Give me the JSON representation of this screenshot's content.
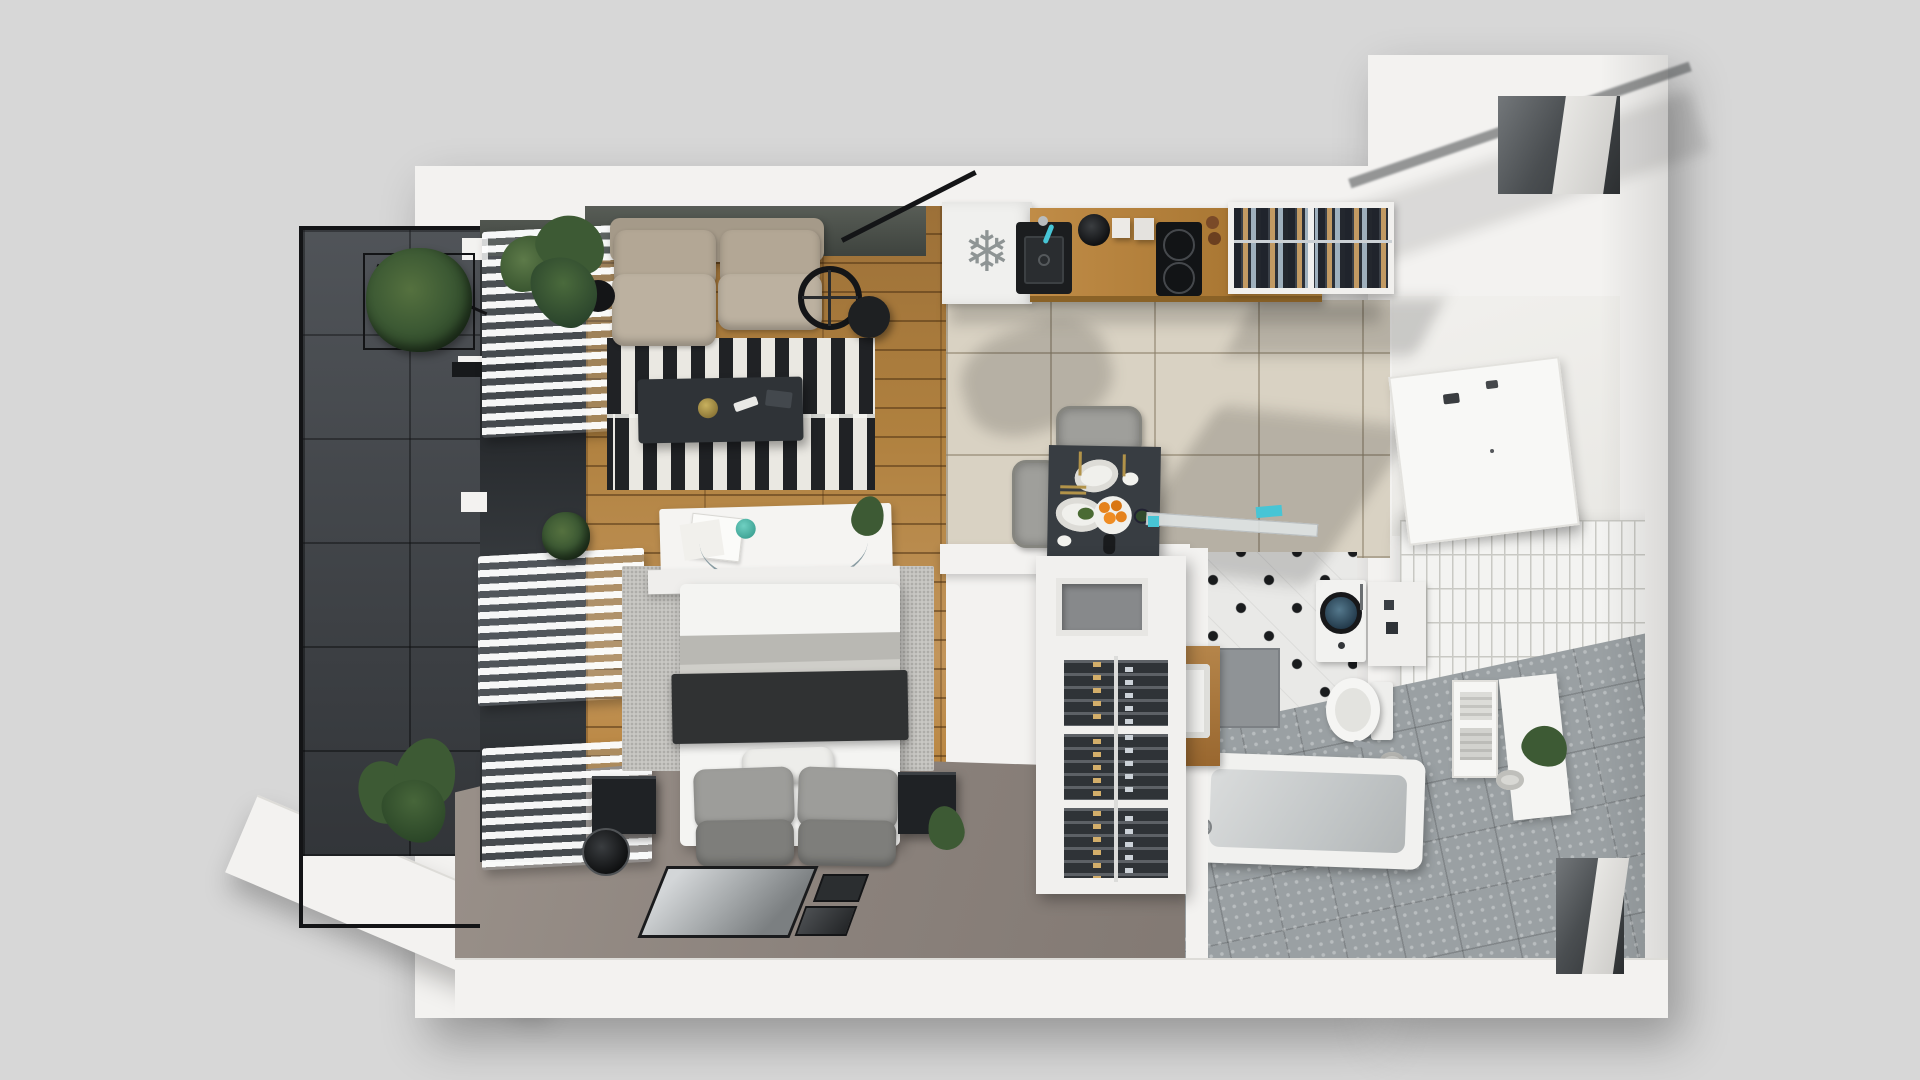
{
  "meta": {
    "scene": "3d-floor-plan-studio-apartment",
    "view": "top-down axonometric architectural render",
    "visible_text": "none"
  },
  "icons": {
    "fridge_snowflake_glyph": "❄"
  },
  "palette": {
    "bg": "#d7d7d7",
    "slab": "#f3f2f0",
    "slab_edge": "#dddcd8",
    "railing": "#131416",
    "balcony_tile": "#43474c",
    "kitchen_tile": "#d9d2c3",
    "hall_floor": "#eeedeb",
    "carpet": "#8e857f",
    "rug_white": "#eae8e2",
    "rug_black": "#202225",
    "rug_bed": "#c9c8c4",
    "sofa": "#b3a795",
    "coffee_table": "#2f3337",
    "bed_white": "#f4f4f2",
    "blanket": "#b9b8b3",
    "throw_dark": "#303233",
    "pillow_light": "#9d9d9a",
    "pillow_dark": "#7e7e7b",
    "speaker": "#1f2225",
    "fridge": "#f0f0ee",
    "snowflake": "#8e9494",
    "counter_wood": "#c08a45",
    "sink": "#1b1d1f",
    "cooktop": "#121416",
    "table": "#383d42",
    "chair": "#9f9f9b",
    "plate": "#f0f0ec",
    "orange": "#e5821c",
    "gold": "#b29349",
    "wardrobe_int": "#2c3036",
    "cloth_tan": "#c29a63",
    "cloth_blue": "#9fb0bd",
    "wine_white": "#f1f0ee",
    "cap_gold": "#d3ae6a",
    "cap_silver": "#ccd2d8",
    "pole": "#dcdcda",
    "dot_tile": "#e9e9e7",
    "dot": "#1a1c1e",
    "drain": "#8f9396",
    "gray_tile": "#9aa0a3",
    "subway": "#f3f3f1",
    "subway_line": "#c9c9c4",
    "teal": "#47c5d5",
    "wood_vanity": "#ad7b3f",
    "plant": "#3d5a34"
  },
  "rooms": {
    "balcony": {
      "planters": 2,
      "blind_groups": 3
    },
    "living_bedroom": {
      "sofa_seats": 2,
      "rug_stripe_rows": 2,
      "bed_pillows_gray": 4,
      "bed_pillows_white": 1,
      "floor_frames": 3,
      "speakers": 2
    },
    "kitchen": {
      "burners": 2,
      "sink_bowls": 1,
      "canisters": 2,
      "grinders": 2,
      "fridge_icon": "snowflake"
    },
    "dining": {
      "chairs": 2,
      "place_settings": 2,
      "orange_fruit_plate": 1
    },
    "wardrobe": {
      "sections": 2,
      "rail": 1
    },
    "wine_rack": {
      "sections": 3,
      "rows_per_section": 5
    },
    "bathroom": {
      "washing_machine": 1,
      "toilet": 1,
      "bathtub": 1,
      "vanity_sink": 1,
      "towel_shelves": 2,
      "toilet_paper_rolls": 2,
      "plants": 1
    },
    "entrances": {
      "top_right_niche": 1,
      "bottom_right_niche": 1
    }
  }
}
